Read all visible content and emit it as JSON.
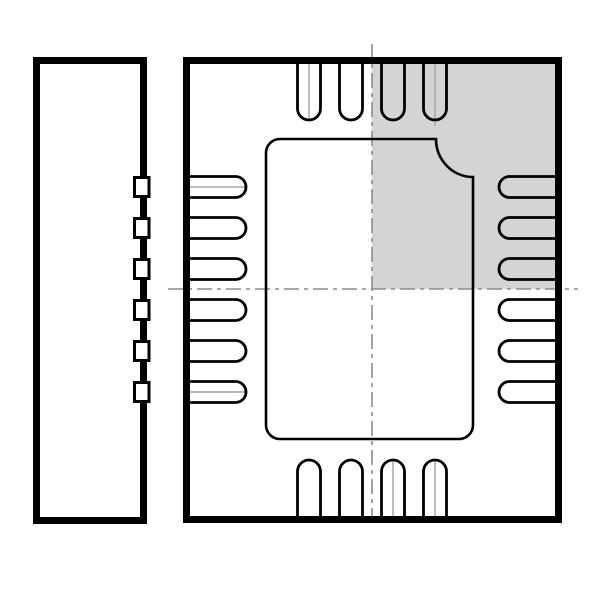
{
  "diagram": {
    "type": "ic-package-outline-drawing",
    "views": {
      "side_view_name": "package-side-view",
      "top_view_name": "package-top-view"
    },
    "colors": {
      "line": "#000000",
      "background": "#ffffff",
      "shading": "#d4d4d4",
      "centerline": "#8c8c8c",
      "marker_line": "#a3a3a3"
    },
    "side_view": {
      "rect": {
        "x": 36.5,
        "y": 60.5,
        "w": 107,
        "h": 460,
        "stroke": 7
      },
      "bumps": {
        "x": 134.5,
        "w": 14.5,
        "h": 19,
        "stroke": 3,
        "centers": [
          187,
          228,
          269,
          310,
          351,
          392
        ]
      }
    },
    "top_view": {
      "rect": {
        "x": 186.5,
        "y": 60.5,
        "w": 372,
        "h": 459,
        "stroke": 7
      },
      "shaded_quadrant": {
        "x": 372,
        "y": 63.5,
        "w": 183.5,
        "h": 225.5
      },
      "center_pad": {
        "left": 266,
        "top": 139,
        "right": 473,
        "bottom": 439,
        "corner_radius": 14,
        "notch_start_x": 436,
        "notch_end_y": 177,
        "stroke": 2.6
      },
      "pins": {
        "stroke": 2.8,
        "top": {
          "orientation": "v",
          "centers": [
            309,
            351,
            393,
            435
          ],
          "half": 11.5,
          "root": 60,
          "cap": 108.5,
          "sweep": 0
        },
        "bottom": {
          "orientation": "v",
          "centers": [
            309,
            351,
            393,
            435
          ],
          "half": 11.5,
          "root": 520,
          "cap": 471.5,
          "sweep": 1
        },
        "left": {
          "orientation": "h",
          "centers": [
            187,
            228,
            269,
            310,
            351,
            392
          ],
          "half": 10.5,
          "root": 186,
          "cap": 235.5,
          "sweep": 1
        },
        "right": {
          "orientation": "h",
          "centers": [
            187,
            228,
            269,
            310,
            351,
            392
          ],
          "half": 10.5,
          "root": 559,
          "cap": 509.5,
          "sweep": 0
        }
      },
      "marker_lines": [
        {
          "dir": "v",
          "pos": 309,
          "from": 62,
          "to": 120
        },
        {
          "dir": "v",
          "pos": 435,
          "from": 62,
          "to": 126
        },
        {
          "dir": "v",
          "pos": 393,
          "from": 460,
          "to": 516
        },
        {
          "dir": "v",
          "pos": 435,
          "from": 460,
          "to": 516
        },
        {
          "dir": "h",
          "pos": 187,
          "from": 190,
          "to": 246
        },
        {
          "dir": "h",
          "pos": 392,
          "from": 188,
          "to": 247
        }
      ],
      "centerlines": {
        "vertical": {
          "x": 372,
          "y1": 44,
          "y2": 516
        },
        "horizontal": {
          "y": 289,
          "x1": 168,
          "x2": 578
        },
        "dash": "15 5 4 5",
        "width": 1.6
      }
    },
    "canvas": {
      "width": 600,
      "height": 590
    }
  }
}
